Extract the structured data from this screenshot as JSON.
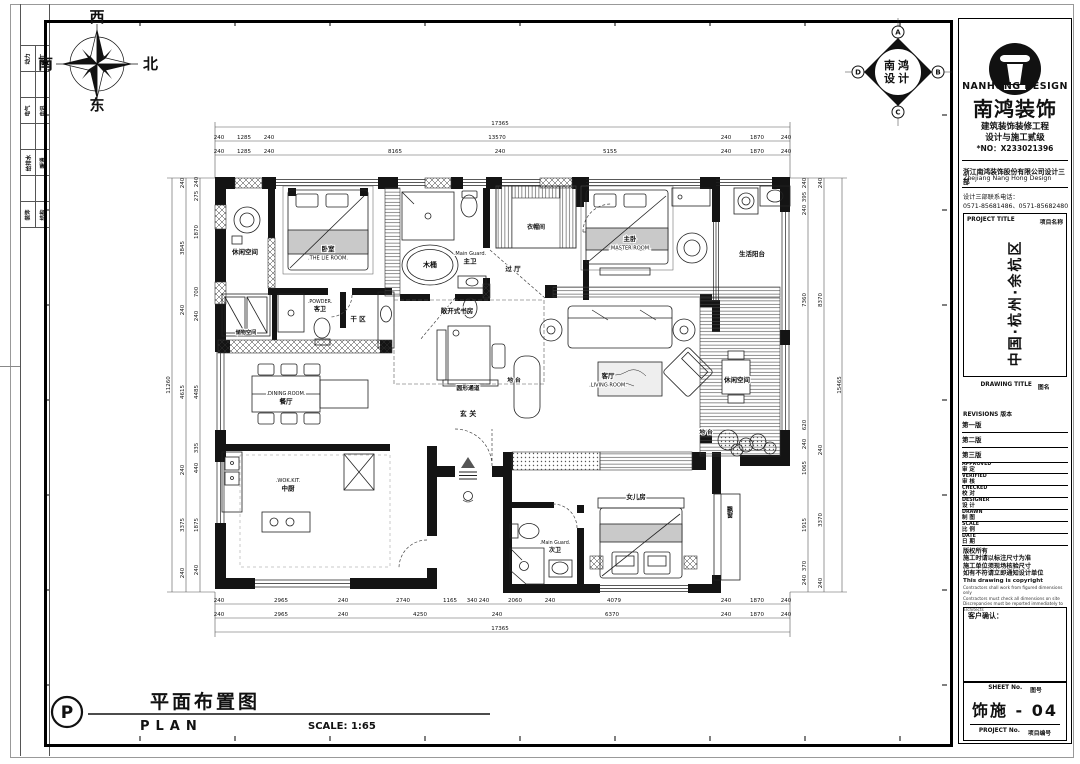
{
  "sheet": {
    "compass": {
      "west": "西",
      "north": "北",
      "south": "南",
      "east": "东"
    },
    "side_strip": {
      "disciplines": [
        [
          "动力",
          "竣工"
        ],
        [
          "电气",
          "电讯"
        ],
        [
          "给排水",
          "暖通"
        ],
        [
          "装饰",
          "结构"
        ]
      ]
    },
    "stamp": {
      "letters": [
        "A",
        "B",
        "C",
        "D"
      ],
      "text_top": "南鸿",
      "text_bottom": "设计"
    },
    "title_block": {
      "logo_en": "NANHONG DESIGN",
      "logo_cn": "南鸿装饰",
      "cert_line1": "建筑装饰装修工程",
      "cert_line2": "设计与施工贰级",
      "cert_no": "*NO：X233021396",
      "company_cn": "浙江南鸿装饰股份有限公司设计三部",
      "company_en": "Zhejiang Nang Hong Design",
      "phone_label": "设计三部联系电话：",
      "phones": "0571-85681486、0571-85682480",
      "project_title_label": "PROJECT TITLE",
      "project_title_label_cn": "项目名称",
      "project_title": "中国·杭州·余杭区",
      "drawing_title_label": "DRAWING TITLE",
      "drawing_title_label_cn": "图名",
      "revisions_label": "REVISIONS",
      "revisions_label_cn": "版本",
      "revisions": [
        "第一版",
        "第二版",
        "第三版"
      ],
      "fields": [
        {
          "en": "APPROVED",
          "cn": "审  定"
        },
        {
          "en": "VERIFIED",
          "cn": "审  核"
        },
        {
          "en": "CHECKED",
          "cn": "校  对"
        },
        {
          "en": "DESIGNER",
          "cn": "设  计"
        },
        {
          "en": "DRAWN",
          "cn": "制  图"
        },
        {
          "en": "SCALE",
          "cn": "比  例"
        },
        {
          "en": "DATE",
          "cn": "日  期"
        }
      ],
      "copyright_cn": [
        "版权所有",
        "施工时请以标注尺寸为准",
        "施工单位须现场核验尺寸",
        "如有不符请立即通知设计单位"
      ],
      "copyright_en": [
        "This drawing is copyright",
        "Contractors shall work from figured dimensions only",
        "Contractors must check all dimensions on site",
        "Discrepancies must be reported immediately to architects"
      ],
      "client_confirm_label": "客户确认：",
      "sheet_no_label": "SHEET No.",
      "sheet_no_label_cn": "图号",
      "sheet_no": "饰施 - 04",
      "project_no_label": "PROJECT No.",
      "project_no_label_cn": "项目编号"
    },
    "footer": {
      "symbol": "P",
      "title_cn": "平面布置图",
      "title_en": "PLAN",
      "scale_label": "SCALE: 1:65"
    }
  },
  "plan": {
    "rooms": [
      {
        "lines": [
          "休闲空间"
        ],
        "x": 245,
        "y": 254,
        "fs": 6.5
      },
      {
        "lines": [
          "卧室",
          ".THE LIE ROOM."
        ],
        "x": 328,
        "y": 251,
        "fs": 6.5
      },
      {
        "lines": [
          "木桶"
        ],
        "x": 430,
        "y": 267,
        "fs": 7
      },
      {
        "lines": [
          ".Main Guard.",
          "主卫"
        ],
        "x": 470,
        "y": 255,
        "fs": 6.5
      },
      {
        "lines": [
          "衣帽间"
        ],
        "x": 536,
        "y": 229,
        "fs": 6
      },
      {
        "lines": [
          "过 厅"
        ],
        "x": 513,
        "y": 271,
        "fs": 6.5
      },
      {
        "lines": [
          "主卧",
          ".MASTER ROOM."
        ],
        "x": 630,
        "y": 241,
        "fs": 6.5
      },
      {
        "lines": [
          "生活阳台"
        ],
        "x": 752,
        "y": 256,
        "fs": 6.5
      },
      {
        "lines": [
          "储物空间"
        ],
        "x": 246,
        "y": 334,
        "fs": 5.2
      },
      {
        "lines": [
          ".POWDER.",
          "客卫"
        ],
        "x": 320,
        "y": 303,
        "fs": 6
      },
      {
        "lines": [
          "干 区"
        ],
        "x": 358,
        "y": 321,
        "fs": 6.5
      },
      {
        "lines": [
          "敞开式书房"
        ],
        "x": 457,
        "y": 313,
        "fs": 6.5
      },
      {
        "lines": [
          "地 台"
        ],
        "x": 514,
        "y": 382,
        "fs": 5.8
      },
      {
        "lines": [
          "圆形通道"
        ],
        "x": 468,
        "y": 390,
        "fs": 5.8
      },
      {
        "lines": [
          "玄 关"
        ],
        "x": 468,
        "y": 416,
        "fs": 7
      },
      {
        "lines": [
          ".DINING ROOM.",
          "餐厅"
        ],
        "x": 286,
        "y": 395,
        "fs": 6.5
      },
      {
        "lines": [
          "客厅",
          ".LIVING ROOM."
        ],
        "x": 608,
        "y": 378,
        "fs": 6.5
      },
      {
        "lines": [
          "休闲空间"
        ],
        "x": 737,
        "y": 382,
        "fs": 6.5
      },
      {
        "lines": [
          "地 台"
        ],
        "x": 706,
        "y": 434,
        "fs": 5.8
      },
      {
        "lines": [
          ".WOK.KIT.",
          "中厨"
        ],
        "x": 288,
        "y": 482,
        "fs": 6.5
      },
      {
        "lines": [
          "女儿房"
        ],
        "x": 636,
        "y": 499,
        "fs": 6.5
      },
      {
        "lines": [
          ".Main Guard.",
          "次卫"
        ],
        "x": 555,
        "y": 544,
        "fs": 6
      },
      {
        "lines": [
          "飘窗"
        ],
        "x": 729,
        "y": 512,
        "fs": 6,
        "vertical": true
      }
    ],
    "dimensions": {
      "top": [
        [
          "17365"
        ],
        [
          "240",
          "1285",
          "240",
          "13570",
          "240",
          "1870",
          "240"
        ],
        [
          "240",
          "1285",
          "240",
          "8165",
          "240",
          "5155",
          "240",
          "1870",
          "240"
        ]
      ],
      "bottom": [
        [
          "240",
          "2965",
          "240",
          "2740",
          "1165",
          "340",
          "240",
          "2060",
          "240",
          "4079",
          "240",
          "1870",
          "240"
        ],
        [
          "240",
          "2965",
          "240",
          "4250",
          "240",
          "6370",
          "240",
          "1870",
          "240"
        ],
        [
          "17365"
        ]
      ],
      "left": [
        [
          "11260"
        ],
        [
          "240",
          "3845",
          "240",
          "4615",
          "240",
          "3375",
          "240"
        ],
        [
          "240",
          "275",
          "1870",
          "700",
          "240",
          "4485",
          "335",
          "440",
          "1875",
          "240"
        ]
      ],
      "right": [
        [
          "240",
          "395",
          "240",
          "7360",
          "620",
          "240",
          "1065",
          "1915",
          "370",
          "240"
        ],
        [
          "240",
          "8370",
          "240",
          "3370",
          "240"
        ],
        [
          "15465"
        ]
      ]
    }
  }
}
